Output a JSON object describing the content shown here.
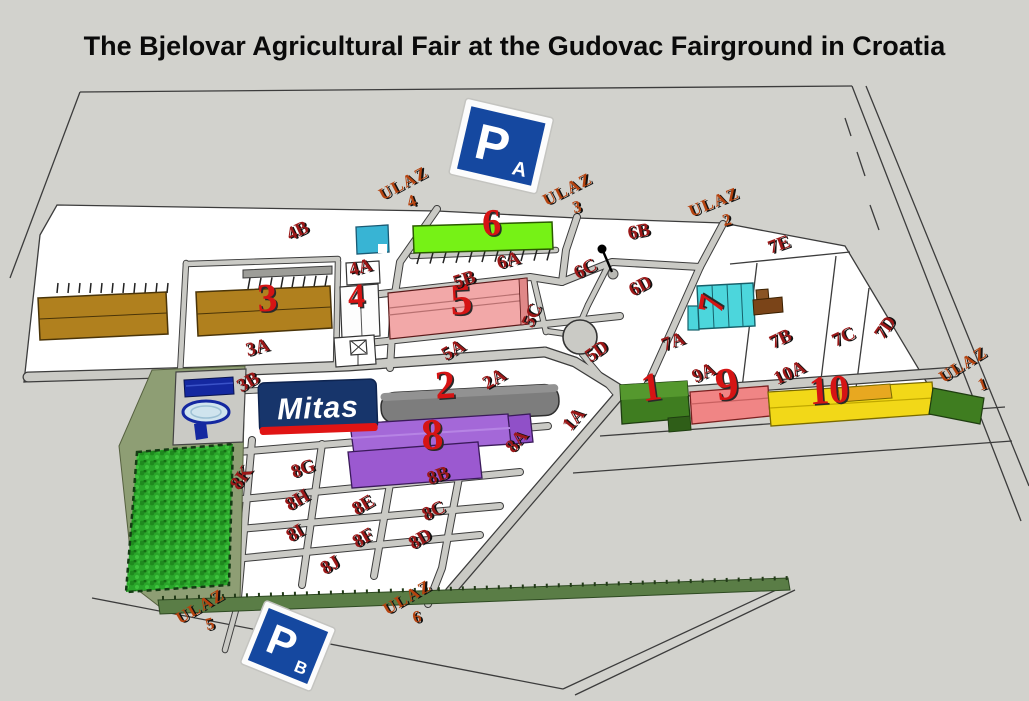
{
  "title": "The Bjelovar Agricultural Fair at the Gudovac Fairground in Croatia",
  "logo": {
    "text": "Mitas"
  },
  "parking_signs": {
    "a": {
      "letter": "P",
      "sub": "A"
    },
    "b": {
      "letter": "P",
      "sub": "B"
    }
  },
  "entrances": {
    "u1": {
      "word": "ULAZ",
      "num": "1"
    },
    "u2": {
      "word": "ULAZ",
      "num": "2"
    },
    "u3": {
      "word": "ULAZ",
      "num": "3"
    },
    "u4": {
      "word": "ULAZ",
      "num": "4"
    },
    "u5": {
      "word": "ULAZ",
      "num": "5"
    },
    "u6": {
      "word": "ULAZ",
      "num": "6"
    }
  },
  "building_numbers": {
    "b1": "1",
    "b2": "2",
    "b3": "3",
    "b4": "4",
    "b5": "5",
    "b6": "6",
    "b7": "7",
    "b8": "8",
    "b9": "9",
    "b10": "10"
  },
  "sector_labels": {
    "s1a": "1A",
    "s2a": "2A",
    "s3a": "3A",
    "s3b": "3B",
    "s4a": "4A",
    "s4b": "4B",
    "s5a": "5A",
    "s5b": "5B",
    "s5c": "5C",
    "s5d": "5D",
    "s6a": "6A",
    "s6b": "6B",
    "s6c": "6C",
    "s6d": "6D",
    "s7a": "7A",
    "s7b": "7B",
    "s7c": "7C",
    "s7d": "7D",
    "s7e": "7E",
    "s8a": "8A",
    "s8b": "8B",
    "s8c": "8C",
    "s8d": "8D",
    "s8e": "8E",
    "s8f": "8F",
    "s8g": "8G",
    "s8h": "8H",
    "s8i": "8I",
    "s8j": "8J",
    "s8k": "8K",
    "s9a": "9A",
    "s10a": "10A"
  },
  "colors": {
    "background": "#d2d2cd",
    "fairground": "#ffffff",
    "road": "#cacac5",
    "building_brown": "#b0801e",
    "building_pink": "#f2a8a8",
    "building_green": "#76f216",
    "building_cyan": "#4cd6dc",
    "building_purple": "#a468d8",
    "building_gray": "#7d7d7d",
    "building_darkgreen": "#3f7d20",
    "building_salmon": "#f08585",
    "building_yellow": "#f2d818",
    "forest": "#27a427",
    "olive": "#8e9e74",
    "sector_red": "#9b1818",
    "entrance_red": "#b5430f",
    "number_red": "#d51414",
    "parking_blue": "#1548a0",
    "mitas_navy": "#17356b",
    "mitas_red": "#e01414",
    "pool_blue": "#1428a0"
  }
}
